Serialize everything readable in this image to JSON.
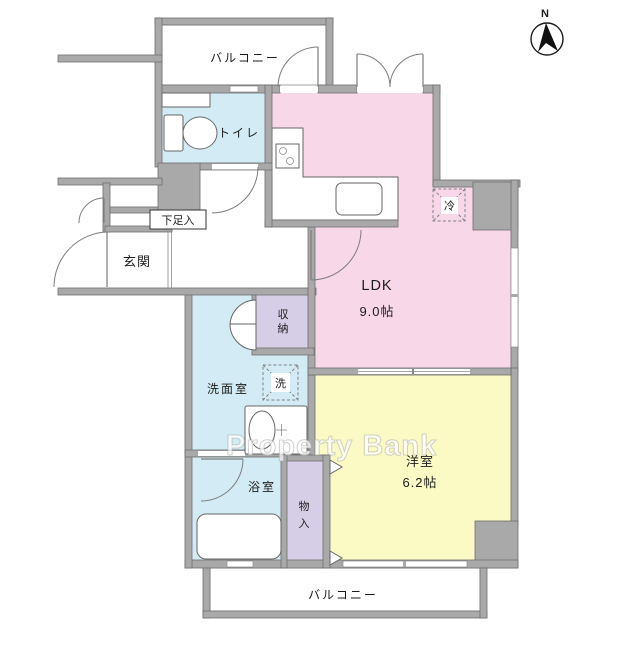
{
  "watermark": {
    "text": "Property Bank"
  },
  "compass": {
    "north_label": "N"
  },
  "rooms": {
    "balcony_top": {
      "label": "バルコニー"
    },
    "balcony_bottom": {
      "label": "バルコニー"
    },
    "toilet": {
      "label": "トイレ"
    },
    "entrance": {
      "label": "玄関"
    },
    "shoe_cabinet": {
      "label": "下足入"
    },
    "ldk": {
      "label": "LDK",
      "size": "9.0帖"
    },
    "western_room": {
      "label": "洋室",
      "size": "6.2帖"
    },
    "washroom": {
      "label": "洗面室"
    },
    "bathroom": {
      "label": "浴室"
    },
    "storage": {
      "char1": "収",
      "char2": "納"
    },
    "closet": {
      "char1": "物",
      "char2": "入"
    },
    "refrigerator": {
      "label": "冷"
    },
    "washing_machine": {
      "label": "洗"
    }
  },
  "colors": {
    "ldk_pink": "#F8D7E8",
    "western_room_yellow": "#FBFAC5",
    "wet_area_blue": "#D2EBF4",
    "storage_purple": "#D6CEE6",
    "wall_gray": "#A9A9A9"
  }
}
